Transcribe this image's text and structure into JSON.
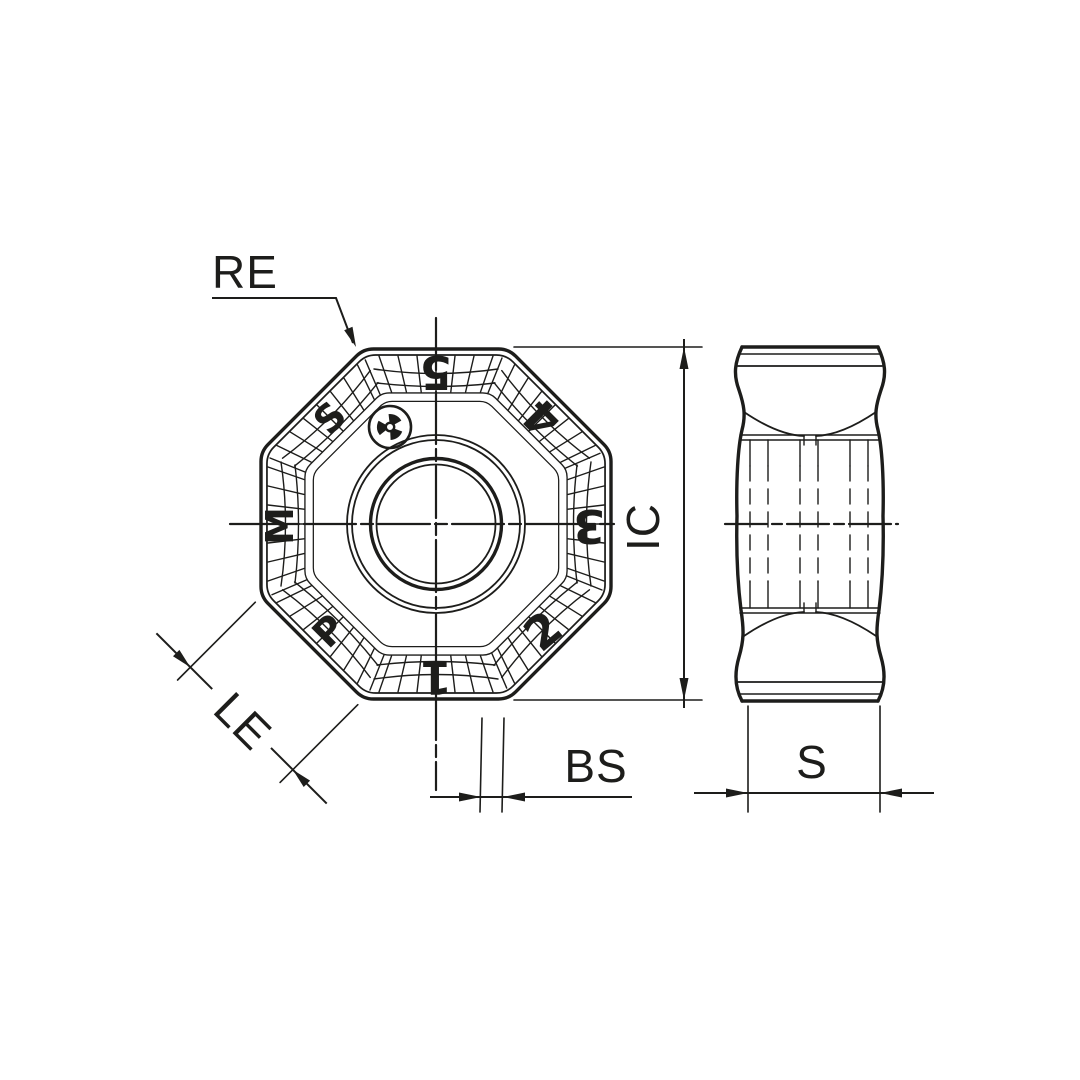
{
  "figure": {
    "kind": "insert-dimension-drawing",
    "views": {
      "front": "octagonal insert face",
      "side": "insert profile"
    }
  },
  "colors": {
    "line": "#1d1d1b",
    "background": "#ffffff"
  },
  "dimensions": {
    "re_label": "RE",
    "ic_label": "IC",
    "le_label": "LE",
    "bs_label": "BS",
    "s_label": "S"
  },
  "front_view": {
    "logo": "trefoil-brand-mark",
    "edge_marks": [
      {
        "position": "top-left",
        "label": "S"
      },
      {
        "position": "top",
        "label": "5"
      },
      {
        "position": "top-right",
        "label": "4"
      },
      {
        "position": "right",
        "label": "3"
      },
      {
        "position": "bottom-right",
        "label": "2"
      },
      {
        "position": "bottom",
        "label": "1"
      },
      {
        "position": "bottom-left",
        "label": "P"
      },
      {
        "position": "left",
        "label": "M"
      }
    ]
  }
}
